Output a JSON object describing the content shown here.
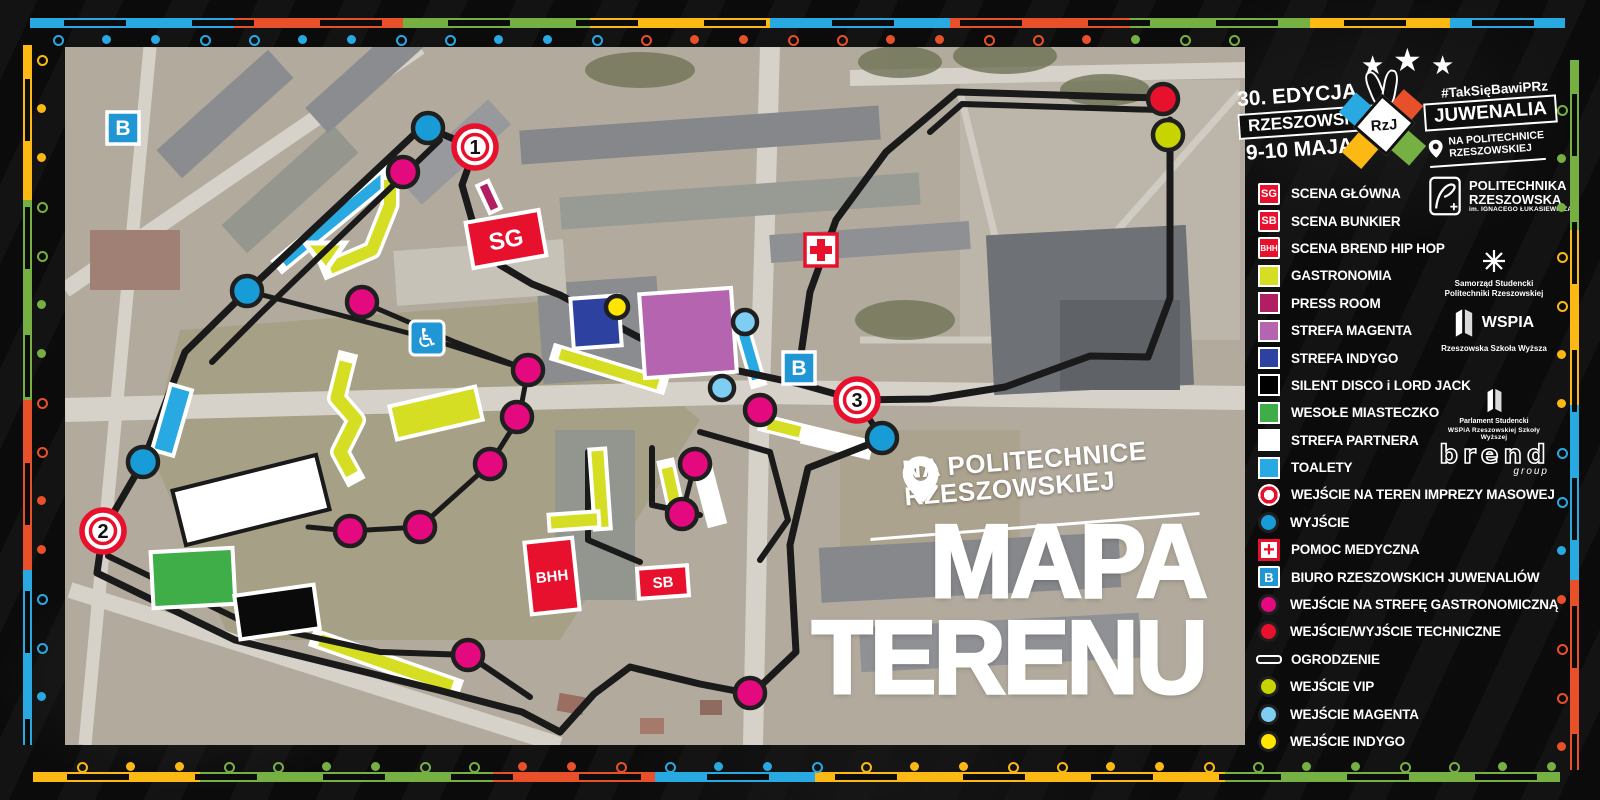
{
  "title": {
    "line1": "MAPA",
    "line2": "TERENU"
  },
  "location_badge": {
    "line1": "NA POLITECHNICE",
    "line2": "RZESZOWSKIEJ"
  },
  "event": {
    "edition": "30. EDYCJA",
    "name_left": "RZESZOWSKIE",
    "monogram": "RzJ",
    "name_right": "JUWENALIA",
    "dates": "9-10 MAJA",
    "hashtag": "#TakSięBawiPRz",
    "venue_line1": "NA POLITECHNICE",
    "venue_line2": "RZESZOWSKIEJ"
  },
  "colors": {
    "red": "#e8112d",
    "yellow": "#d6de23",
    "press": "#b11f63",
    "orchid": "#b565b0",
    "indigo": "#2d41a0",
    "green": "#3fae49",
    "white": "#ffffff",
    "cyan": "#29a9e1",
    "exit": "#189cd8",
    "magenta": "#e5097f",
    "vip": "#c8d400",
    "lightblue": "#7ecef4",
    "yellowdot": "#ffe500",
    "fence": "#1a1a1a",
    "b_blue": "#2196d4",
    "border_blue": "#29a9e1",
    "border_orange": "#e8502a",
    "border_green": "#76b043",
    "border_yellow": "#fdb913"
  },
  "legend": {
    "items": [
      {
        "label": "SCENA  GŁÓWNA",
        "swatch": {
          "kind": "tag",
          "color": "red",
          "text": "SG",
          "fs": 11
        }
      },
      {
        "label": "SCENA BUNKIER",
        "swatch": {
          "kind": "tag",
          "color": "red",
          "text": "SB",
          "fs": 11
        }
      },
      {
        "label": "SCENA BREND HIP HOP",
        "swatch": {
          "kind": "tag",
          "color": "red",
          "text": "BHH",
          "fs": 8
        }
      },
      {
        "label": "GASTRONOMIA",
        "swatch": {
          "kind": "square",
          "color": "yellow"
        }
      },
      {
        "label": "PRESS ROOM",
        "swatch": {
          "kind": "square",
          "color": "press"
        }
      },
      {
        "label": "STREFA MAGENTA",
        "swatch": {
          "kind": "square",
          "color": "orchid"
        }
      },
      {
        "label": "STREFA INDYGO",
        "swatch": {
          "kind": "square",
          "color": "indigo"
        }
      },
      {
        "label": "SILENT DISCO i LORD JACK",
        "swatch": {
          "kind": "square",
          "color": "#000000"
        }
      },
      {
        "label": "WESOŁE MIASTECZKO",
        "swatch": {
          "kind": "square",
          "color": "green"
        }
      },
      {
        "label": "STREFA PARTNERA",
        "swatch": {
          "kind": "square",
          "color": "white"
        }
      },
      {
        "label": "TOALETY",
        "swatch": {
          "kind": "square",
          "color": "cyan"
        }
      },
      {
        "label": "WEJŚCIE NA TEREN IMPREZY MASOWEJ",
        "swatch": {
          "kind": "ring"
        }
      },
      {
        "label": "WYJŚCIE",
        "swatch": {
          "kind": "circle",
          "color": "exit"
        }
      },
      {
        "label": "POMOC MEDYCZNA",
        "swatch": {
          "kind": "cross",
          "text": "+"
        }
      },
      {
        "label": "BIURO RZESZOWSKICH JUWENALIÓW",
        "swatch": {
          "kind": "tag",
          "color": "b_blue",
          "text": "B",
          "fs": 13
        }
      },
      {
        "label": "WEJŚCIE NA STREFĘ GASTRONOMICZNĄ",
        "swatch": {
          "kind": "circle",
          "color": "magenta"
        }
      },
      {
        "label": "WEJŚCIE/WYJŚCIE TECHNICZNE",
        "swatch": {
          "kind": "circle",
          "color": "red"
        }
      },
      {
        "label": "OGRODZENIE",
        "swatch": {
          "kind": "line"
        }
      },
      {
        "label": "WEJŚCIE VIP",
        "swatch": {
          "kind": "circle",
          "color": "vip"
        }
      },
      {
        "label": "WEJŚCIE MAGENTA",
        "swatch": {
          "kind": "circle",
          "color": "lightblue"
        }
      },
      {
        "label": "WEJŚCIE INDYGO",
        "swatch": {
          "kind": "circle",
          "color": "yellowdot"
        }
      }
    ]
  },
  "sponsors": [
    {
      "name": "POLITECHNIKA RZESZOWSKA",
      "sub": "im. IGNACEGO ŁUKASIEWICZA",
      "icon": "politechnika-logo"
    },
    {
      "name": "Samorząd Studencki",
      "sub": "Politechniki Rzeszowskiej",
      "icon": "samorzad-logo"
    },
    {
      "name": "WSPIA",
      "sub": "Rzeszowska Szkoła Wyższa",
      "icon": "wspia-logo"
    },
    {
      "name": "Parlament Studencki",
      "sub": "WSPiA Rzeszowskiej Szkoły Wyższej",
      "icon": "parlament-logo"
    },
    {
      "name": "brend",
      "sub": "group",
      "icon": "brend-logo"
    }
  ],
  "map": {
    "fences": [
      {
        "pts": [
          [
            422,
            127
          ],
          [
            240,
            298
          ],
          [
            185,
            352
          ],
          [
            143,
            462
          ],
          [
            103,
            531
          ],
          [
            97,
            573
          ]
        ],
        "w": 7
      },
      {
        "pts": [
          [
            440,
            140
          ],
          [
            262,
            312
          ],
          [
            212,
            362
          ]
        ],
        "w": 6
      },
      {
        "pts": [
          [
            97,
            573
          ],
          [
            235,
            640
          ],
          [
            438,
            690
          ],
          [
            522,
            712
          ],
          [
            560,
            732
          ],
          [
            594,
            694
          ],
          [
            630,
            667
          ],
          [
            700,
            684
          ],
          [
            752,
            694
          ],
          [
            796,
            652
          ],
          [
            790,
            545
          ],
          [
            808,
            468
          ],
          [
            880,
            440
          ]
        ],
        "w": 7
      },
      {
        "pts": [
          [
            108,
            556
          ],
          [
            244,
            622
          ],
          [
            380,
            652
          ],
          [
            468,
            655
          ],
          [
            530,
            697
          ]
        ],
        "w": 6
      },
      {
        "pts": [
          [
            428,
            128
          ],
          [
            475,
            148
          ],
          [
            462,
            185
          ],
          [
            472,
            220
          ],
          [
            500,
            265
          ],
          [
            532,
            284
          ],
          [
            560,
            295
          ]
        ],
        "w": 7
      },
      {
        "pts": [
          [
            560,
            295
          ],
          [
            640,
            338
          ],
          [
            720,
            367
          ],
          [
            800,
            384
          ],
          [
            857,
            400
          ],
          [
            930,
            399
          ],
          [
            1005,
            387
          ],
          [
            1090,
            356
          ],
          [
            1148,
            357
          ],
          [
            1170,
            298
          ],
          [
            1170,
            120
          ]
        ],
        "w": 7
      },
      {
        "pts": [
          [
            1158,
            98
          ],
          [
            957,
            92
          ],
          [
            886,
            152
          ],
          [
            836,
            220
          ],
          [
            810,
            292
          ],
          [
            799,
            368
          ],
          [
            800,
            384
          ]
        ],
        "w": 7
      },
      {
        "pts": [
          [
            1158,
            110
          ],
          [
            962,
            104
          ],
          [
            930,
            132
          ]
        ],
        "w": 6
      },
      {
        "pts": [
          [
            362,
            302
          ],
          [
            455,
            342
          ],
          [
            528,
            370
          ],
          [
            519,
            418
          ],
          [
            490,
            464
          ],
          [
            420,
            527
          ],
          [
            350,
            531
          ],
          [
            308,
            527
          ]
        ],
        "w": 5
      },
      {
        "pts": [
          [
            247,
            291
          ],
          [
            340,
            315
          ],
          [
            427,
            338
          ],
          [
            528,
            370
          ]
        ],
        "w": 5
      },
      {
        "pts": [
          [
            857,
            400
          ],
          [
            882,
            438
          ]
        ],
        "w": 6
      },
      {
        "pts": [
          [
            588,
            452
          ],
          [
            588,
            540
          ],
          [
            640,
            562
          ]
        ],
        "w": 6
      },
      {
        "pts": [
          [
            652,
            448
          ],
          [
            652,
            505
          ],
          [
            700,
            515
          ]
        ],
        "w": 6
      },
      {
        "pts": [
          [
            700,
            432
          ],
          [
            770,
            452
          ],
          [
            788,
            520
          ],
          [
            760,
            560
          ]
        ],
        "w": 6
      },
      {
        "pts": [
          [
            695,
            464
          ],
          [
            682,
            514
          ]
        ],
        "w": 5
      }
    ],
    "stripes": [
      {
        "pts": [
          [
            283,
            262
          ],
          [
            395,
            170
          ]
        ],
        "w": 11,
        "c": "cyan"
      },
      {
        "pts": [
          [
            330,
            268
          ],
          [
            372,
            250
          ],
          [
            390,
            205
          ],
          [
            390,
            180
          ]
        ],
        "w": 12,
        "c": "yellow"
      },
      {
        "poly": [
          [
            305,
            243
          ],
          [
            345,
            243
          ],
          [
            326,
            270
          ]
        ],
        "c": "yellow"
      },
      {
        "pts": [
          [
            346,
            362
          ],
          [
            337,
            398
          ],
          [
            356,
            420
          ],
          [
            340,
            452
          ],
          [
            352,
            474
          ]
        ],
        "w": 13,
        "c": "yellow"
      },
      {
        "pts": [
          [
            560,
            354
          ],
          [
            658,
            384
          ]
        ],
        "w": 11,
        "c": "yellow"
      },
      {
        "pts": [
          [
            743,
            331
          ],
          [
            757,
            379
          ]
        ],
        "w": 10,
        "c": "cyan"
      },
      {
        "pts": [
          [
            768,
            424
          ],
          [
            800,
            432
          ]
        ],
        "w": 11,
        "c": "yellow"
      },
      {
        "pts": [
          [
            812,
            436
          ],
          [
            862,
            448
          ]
        ],
        "w": 13,
        "c": "white"
      },
      {
        "pts": [
          [
            320,
            640
          ],
          [
            452,
            686
          ]
        ],
        "w": 12,
        "c": "yellow"
      },
      {
        "pts": [
          [
            667,
            468
          ],
          [
            675,
            504
          ]
        ],
        "w": 11,
        "c": "yellow"
      },
      {
        "pts": [
          [
            705,
            478
          ],
          [
            715,
            516
          ]
        ],
        "w": 13,
        "c": "white"
      }
    ],
    "zones": [
      {
        "x": 506,
        "y": 239,
        "w": 74,
        "h": 46,
        "r": -10,
        "c": "red",
        "label": "SG",
        "ls": 24
      },
      {
        "x": 552,
        "y": 576,
        "w": 48,
        "h": 72,
        "r": -6,
        "c": "red",
        "label": "BHH",
        "ls": 15
      },
      {
        "x": 663,
        "y": 582,
        "w": 50,
        "h": 30,
        "r": -4,
        "c": "red",
        "label": "SB",
        "ls": 15
      },
      {
        "x": 596,
        "y": 322,
        "w": 48,
        "h": 50,
        "r": -4,
        "c": "indigo"
      },
      {
        "x": 688,
        "y": 333,
        "w": 92,
        "h": 84,
        "r": -4,
        "c": "orchid"
      },
      {
        "x": 489,
        "y": 197,
        "w": 12,
        "h": 30,
        "r": -25,
        "c": "press"
      },
      {
        "x": 251,
        "y": 500,
        "w": 148,
        "h": 56,
        "r": -14,
        "c": "white",
        "stroke": "#1a1a1a"
      },
      {
        "x": 193,
        "y": 578,
        "w": 82,
        "h": 56,
        "r": -3,
        "c": "green"
      },
      {
        "x": 277,
        "y": 612,
        "w": 80,
        "h": 44,
        "r": -8,
        "c": "#0a0a0a"
      },
      {
        "x": 172,
        "y": 420,
        "w": 22,
        "h": 68,
        "r": 16,
        "c": "cyan"
      },
      {
        "x": 436,
        "y": 413,
        "w": 88,
        "h": 34,
        "r": -13,
        "c": "yellow"
      },
      {
        "x": 600,
        "y": 489,
        "w": 16,
        "h": 80,
        "r": -4,
        "c": "yellow"
      },
      {
        "x": 574,
        "y": 521,
        "w": 50,
        "h": 16,
        "r": -4,
        "c": "yellow"
      }
    ],
    "markers": [
      {
        "x": 403,
        "y": 172,
        "c": "magenta"
      },
      {
        "x": 362,
        "y": 302,
        "c": "magenta"
      },
      {
        "x": 528,
        "y": 370,
        "c": "magenta"
      },
      {
        "x": 517,
        "y": 417,
        "c": "magenta"
      },
      {
        "x": 490,
        "y": 464,
        "c": "magenta"
      },
      {
        "x": 420,
        "y": 527,
        "c": "magenta"
      },
      {
        "x": 350,
        "y": 531,
        "c": "magenta"
      },
      {
        "x": 695,
        "y": 464,
        "c": "magenta"
      },
      {
        "x": 682,
        "y": 514,
        "c": "magenta"
      },
      {
        "x": 760,
        "y": 410,
        "c": "magenta"
      },
      {
        "x": 468,
        "y": 655,
        "c": "magenta"
      },
      {
        "x": 750,
        "y": 693,
        "c": "magenta"
      },
      {
        "x": 428,
        "y": 128,
        "c": "exit"
      },
      {
        "x": 247,
        "y": 291,
        "c": "exit"
      },
      {
        "x": 143,
        "y": 462,
        "c": "exit"
      },
      {
        "x": 882,
        "y": 438,
        "c": "exit"
      },
      {
        "x": 1163,
        "y": 99,
        "c": "red"
      },
      {
        "x": 1168,
        "y": 135,
        "c": "vip"
      },
      {
        "x": 745,
        "y": 322,
        "c": "lightblue",
        "r": 12
      },
      {
        "x": 722,
        "y": 388,
        "c": "lightblue",
        "r": 12
      },
      {
        "x": 617,
        "y": 307,
        "c": "yellowdot",
        "r": 11
      }
    ],
    "gates": [
      {
        "x": 475,
        "y": 147,
        "n": "1"
      },
      {
        "x": 103,
        "y": 531,
        "n": "2"
      },
      {
        "x": 857,
        "y": 400,
        "n": "3"
      }
    ],
    "badges": [
      {
        "x": 123,
        "y": 128,
        "t": "b"
      },
      {
        "x": 799,
        "y": 368,
        "t": "b"
      },
      {
        "x": 821,
        "y": 250,
        "t": "medical"
      },
      {
        "x": 427,
        "y": 338,
        "t": "wheelchair"
      }
    ]
  },
  "border_dots": {
    "top": {
      "axis": "x",
      "fixed": 35,
      "from": 53,
      "to": 1240,
      "step": 49,
      "segments": [
        {
          "until": 612,
          "c": "border_blue"
        },
        {
          "until": 1120,
          "c": "border_orange"
        },
        {
          "until": 1300,
          "c": "border_green"
        }
      ]
    },
    "bottom": {
      "axis": "x",
      "fixed": 762,
      "from": 77,
      "to": 1555,
      "step": 49,
      "segments": [
        {
          "until": 198,
          "c": "border_yellow"
        },
        {
          "until": 493,
          "c": "border_green"
        },
        {
          "until": 653,
          "c": "border_orange"
        },
        {
          "until": 813,
          "c": "border_blue"
        },
        {
          "until": 1225,
          "c": "border_yellow"
        },
        {
          "until": 1600,
          "c": "border_green"
        }
      ]
    },
    "left": {
      "axis": "y",
      "fixed": 37,
      "from": 55,
      "to": 740,
      "step": 49,
      "segments": [
        {
          "until": 197,
          "c": "border_yellow"
        },
        {
          "until": 395,
          "c": "border_green"
        },
        {
          "until": 560,
          "c": "border_orange"
        },
        {
          "until": 800,
          "c": "border_blue"
        }
      ]
    },
    "right": {
      "axis": "y",
      "fixed": 1557,
      "from": 105,
      "to": 745,
      "step": 49,
      "segments": [
        {
          "until": 230,
          "c": "border_green"
        },
        {
          "until": 405,
          "c": "border_yellow"
        },
        {
          "until": 580,
          "c": "border_blue"
        },
        {
          "until": 800,
          "c": "border_orange"
        }
      ]
    }
  }
}
